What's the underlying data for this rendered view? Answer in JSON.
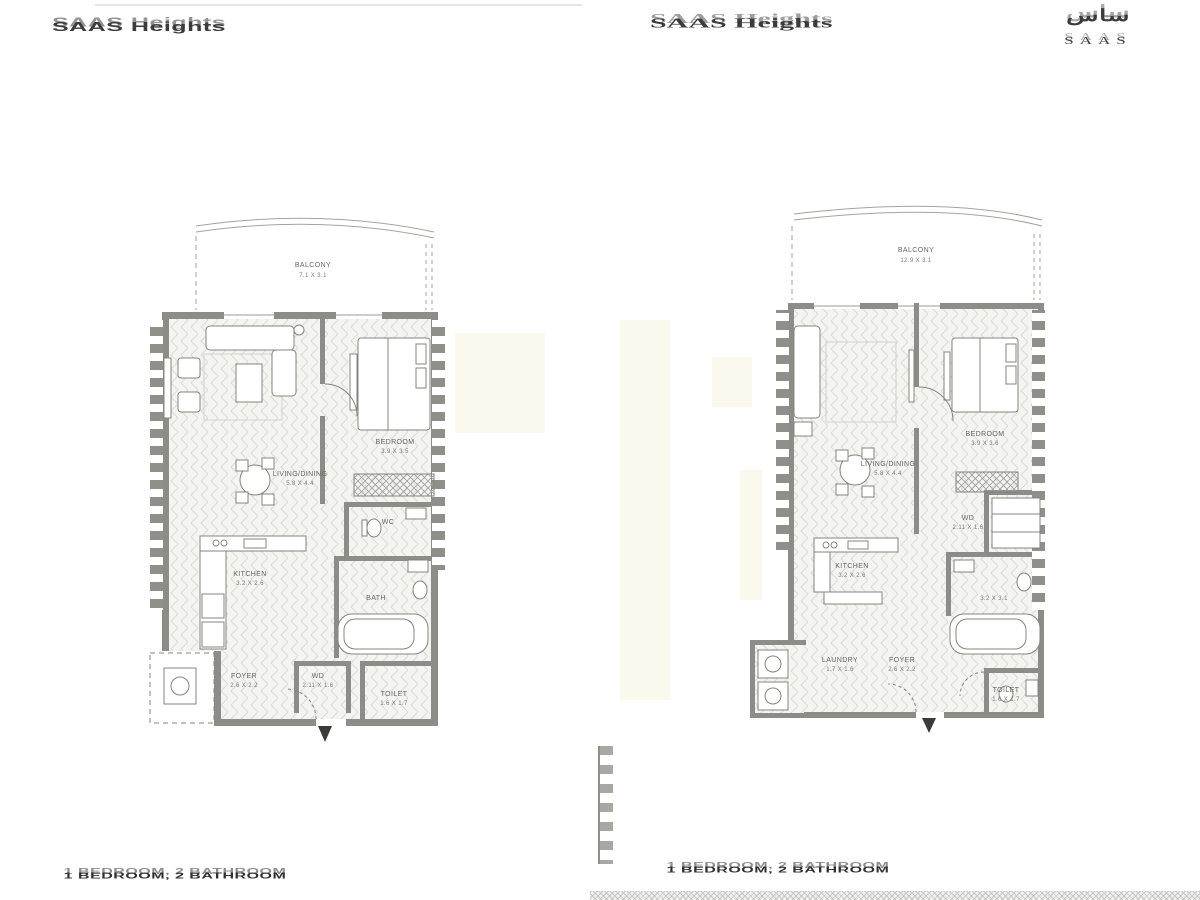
{
  "header": {
    "brand_left": "SAAS Heights",
    "brand_center": "SAAS Heights",
    "brand_right_arabic": "ساس",
    "brand_right_latin": "SAAS"
  },
  "colors": {
    "wall_gray": "#8d8d87",
    "floor_line": "#dcdcd7",
    "label_text": "#67675f",
    "caption_text": "#2f2f2f",
    "watermark_beige": "#fbf8ee"
  },
  "plans": {
    "left": {
      "caption": "1 BEDROOM, 2 BATHROOM",
      "balcony_label": "BALCONY",
      "balcony_dim": "7.1 X 3.1",
      "bedroom_label": "BEDROOM",
      "bedroom_dim": "3.9 X 3.5",
      "living_label": "LIVING/DINING",
      "living_dim": "5.8 X 4.4",
      "kitchen_label": "KITCHEN",
      "kitchen_dim": "3.2 X 2.6",
      "wc_label": "WC",
      "bath_label": "BATH",
      "foyer_label": "FOYER",
      "foyer_dim": "2.6 X 2.2",
      "wd_label": "WD",
      "wd_dim": "2.11 X 1.6",
      "toilet_label": "TOILET",
      "toilet_dim": "1.6 X 1.7"
    },
    "right": {
      "caption": "1 BEDROOM, 2 BATHROOM",
      "balcony_label": "BALCONY",
      "balcony_dim": "12.9 X 3.1",
      "bedroom_label": "BEDROOM",
      "bedroom_dim": "3.9 X 3.6",
      "living_label": "LIVING/DINING",
      "living_dim": "5.8 X 4.4",
      "kitchen_label": "KITCHEN",
      "kitchen_dim": "3.2 X 2.6",
      "bath_dim": "3.2 X 3.1",
      "laundry_label": "LAUNDRY",
      "laundry_dim": "1.7 X 1.6",
      "foyer_label": "FOYER",
      "foyer_dim": "2.6 X 2.2",
      "wd_label": "WD",
      "wd_dim": "2.11 X 1.6",
      "toilet_label": "TOILET",
      "toilet_dim": "1.6 X 1.7"
    }
  }
}
